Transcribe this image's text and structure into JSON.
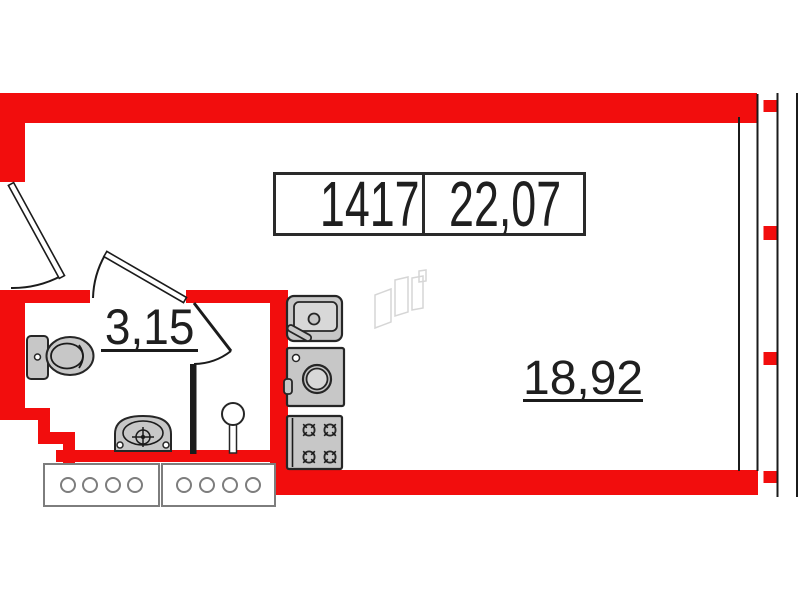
{
  "plan": {
    "title": "apartment-floor-plan",
    "unit_label": {
      "number": "1417",
      "total_area": "22,07"
    },
    "rooms": [
      {
        "id": "bathroom",
        "area_label": "3,15"
      },
      {
        "id": "main-room",
        "area_label": "18,92"
      }
    ],
    "fixture_icons": [
      "toilet-icon",
      "wash-basin-icon",
      "riser-pipe-icon",
      "kitchen-sink-icon",
      "washing-machine-icon",
      "stove-icon",
      "radiator-icon",
      "radiator-icon",
      "developer-watermark"
    ],
    "colors": {
      "wall_red": "#f20d0d",
      "line_black": "#1b1b1b",
      "fixture_fill": "#c7c7c7",
      "fixture_inner": "#d8d8d8",
      "fixture_stroke": "#262626",
      "radiator_stroke": "#7d7d7d",
      "watermark": "#d6d6d6",
      "text": "#1f1f1f"
    }
  }
}
